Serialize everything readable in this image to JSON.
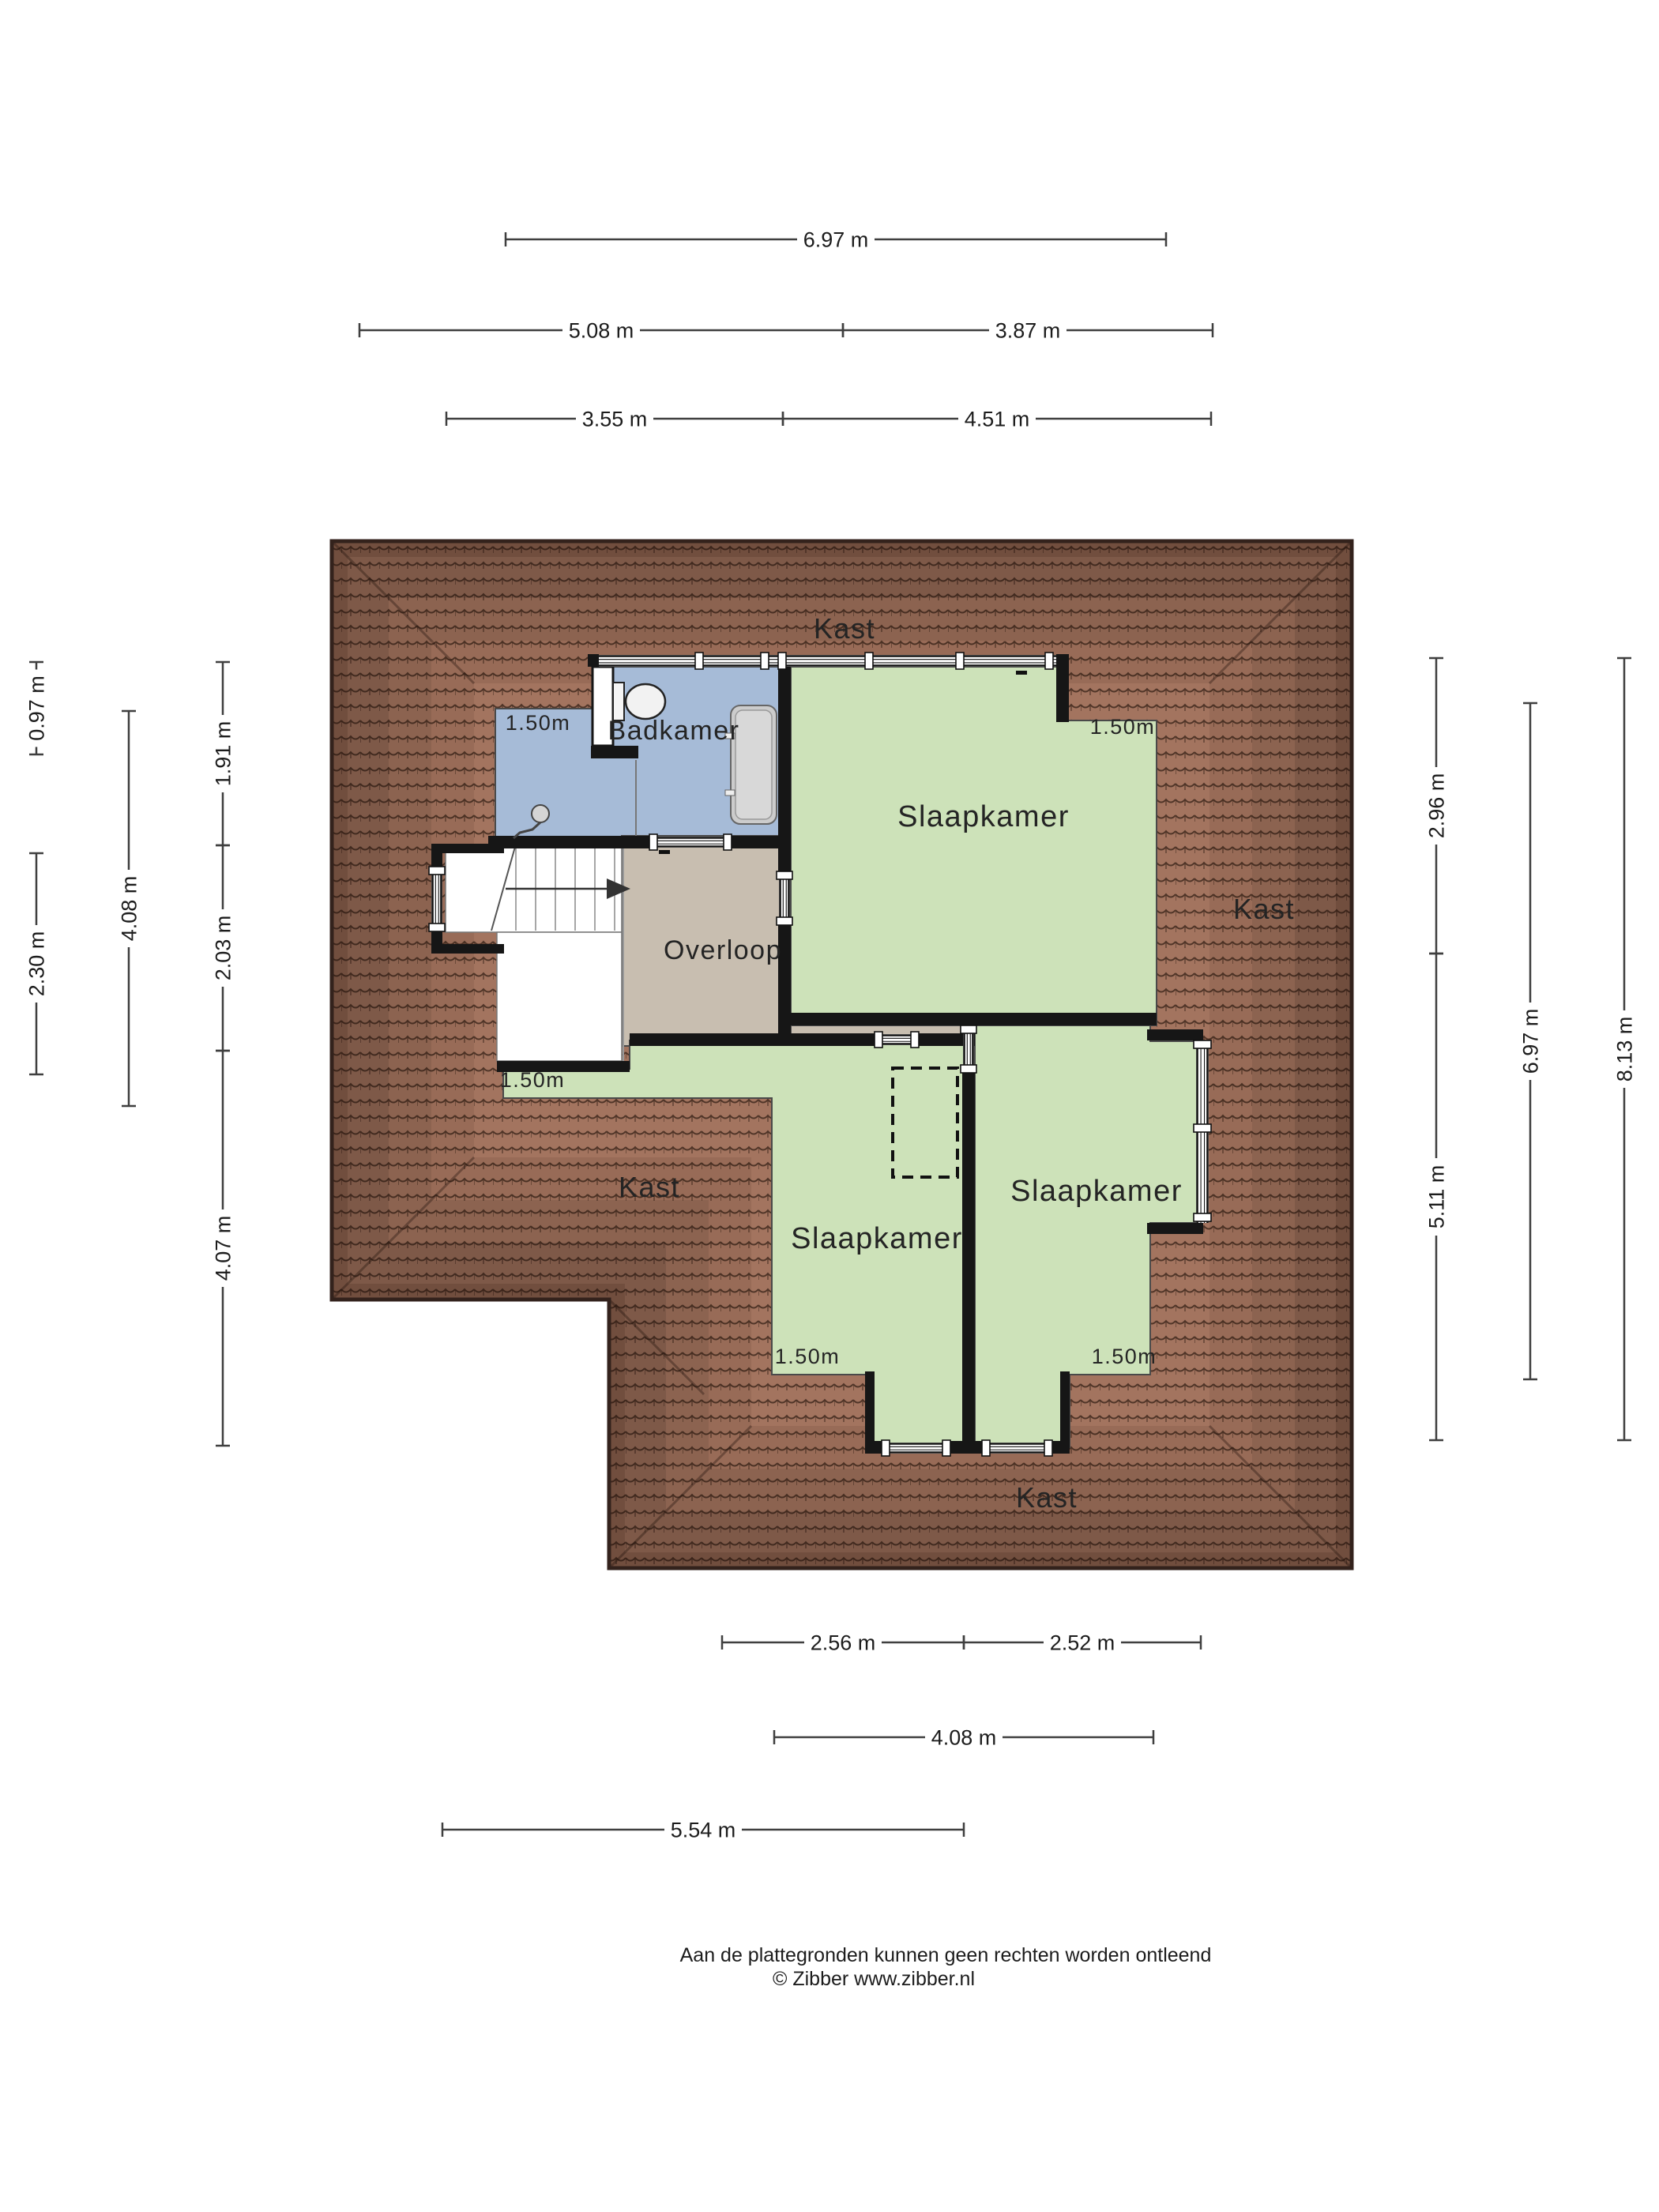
{
  "plan": {
    "rooms": {
      "badkamer": "Badkamer",
      "slaapkamer_top": "Slaapkamer",
      "slaapkamer_mid": "Slaapkamer",
      "slaapkamer_right": "Slaapkamer",
      "overloop": "Overloop",
      "kast_top": "Kast",
      "kast_right": "Kast",
      "kast_left": "Kast",
      "kast_bottom": "Kast"
    },
    "height_markers": {
      "bath": "1.50m",
      "bed_top": "1.50m",
      "stairs": "1.50m",
      "bed_mid": "1.50m",
      "bed_right": "1.50m"
    },
    "dimensions": {
      "top": [
        {
          "id": "t1",
          "label": "6.97 m"
        },
        {
          "id": "t2",
          "label": "5.08 m"
        },
        {
          "id": "t3",
          "label": "3.87 m"
        },
        {
          "id": "t4",
          "label": "3.55 m"
        },
        {
          "id": "t5",
          "label": "4.51 m"
        }
      ],
      "bottom": [
        {
          "id": "b1",
          "label": "2.56 m"
        },
        {
          "id": "b2",
          "label": "2.52 m"
        },
        {
          "id": "b3",
          "label": "4.08 m"
        },
        {
          "id": "b4",
          "label": "5.54 m"
        }
      ],
      "left": [
        {
          "id": "l1",
          "label": "0.97 m"
        },
        {
          "id": "l2",
          "label": "2.30 m"
        },
        {
          "id": "l3",
          "label": "4.08 m"
        },
        {
          "id": "l4",
          "label": "1.91 m"
        },
        {
          "id": "l5",
          "label": "2.03 m"
        },
        {
          "id": "l6",
          "label": "4.07 m"
        }
      ],
      "right": [
        {
          "id": "r1",
          "label": "2.96 m"
        },
        {
          "id": "r2",
          "label": "5.11 m"
        },
        {
          "id": "r3",
          "label": "6.97 m"
        },
        {
          "id": "r4",
          "label": "8.13 m"
        }
      ]
    },
    "footer": {
      "line1": "Aan de plattegronden kunnen geen rechten worden ontleend",
      "line2": "© Zibber www.zibber.nl"
    },
    "colors": {
      "bedroom": "#cde2b9",
      "bathroom": "#a6bbd7",
      "landing": "#c8beb0",
      "roof_base": "#a3745f",
      "roof_line": "#503528",
      "roof_edge": "#33221c",
      "wall": "#161616",
      "dim": "#3f3f3f",
      "text": "#242424"
    }
  }
}
